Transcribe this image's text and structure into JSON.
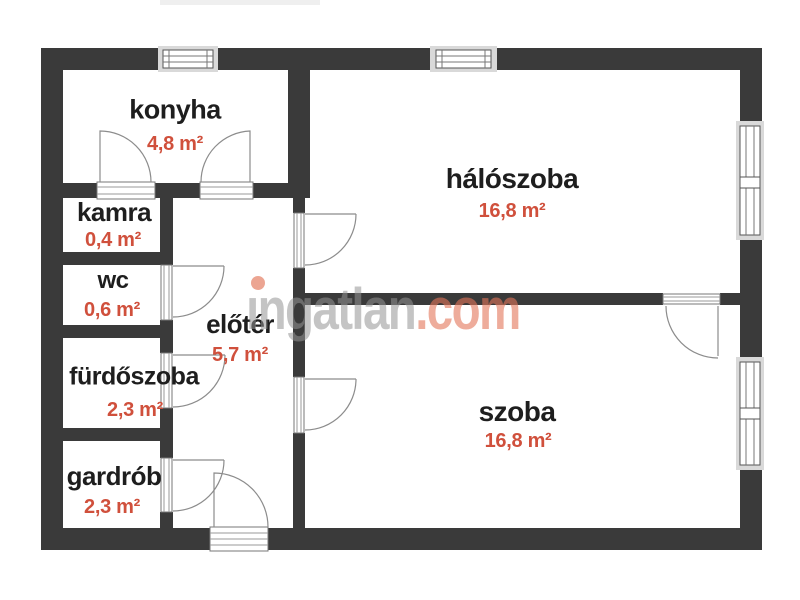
{
  "plan_title": "apartment floor plan",
  "rooms": {
    "konyha": {
      "name": "konyha",
      "area": "4,8 m²"
    },
    "kamra": {
      "name": "kamra",
      "area": "0,4 m²"
    },
    "wc": {
      "name": "wc",
      "area": "0,6 m²"
    },
    "furdoszoba": {
      "name": "fürdőszoba",
      "area": "2,3 m²"
    },
    "gardrob": {
      "name": "gardrób",
      "area": "2,3 m²"
    },
    "eloter": {
      "name": "előtér",
      "area": "5,7 m²"
    },
    "haloszoba": {
      "name": "hálószoba",
      "area": "16,8 m²"
    },
    "szoba": {
      "name": "szoba",
      "area": "16,8 m²"
    }
  },
  "watermark": {
    "brand_gray": "ıngatlan",
    "brand_accent": ".com"
  },
  "colors": {
    "wall": "#3a3a3a",
    "room_name_text": "#1e1e1e",
    "area_text": "#d0503c",
    "window_band": "#d9d9d9",
    "door_line": "#8c8c8c",
    "watermark_gray": "#c6c6c6",
    "watermark_accent": "#e8a08a"
  }
}
